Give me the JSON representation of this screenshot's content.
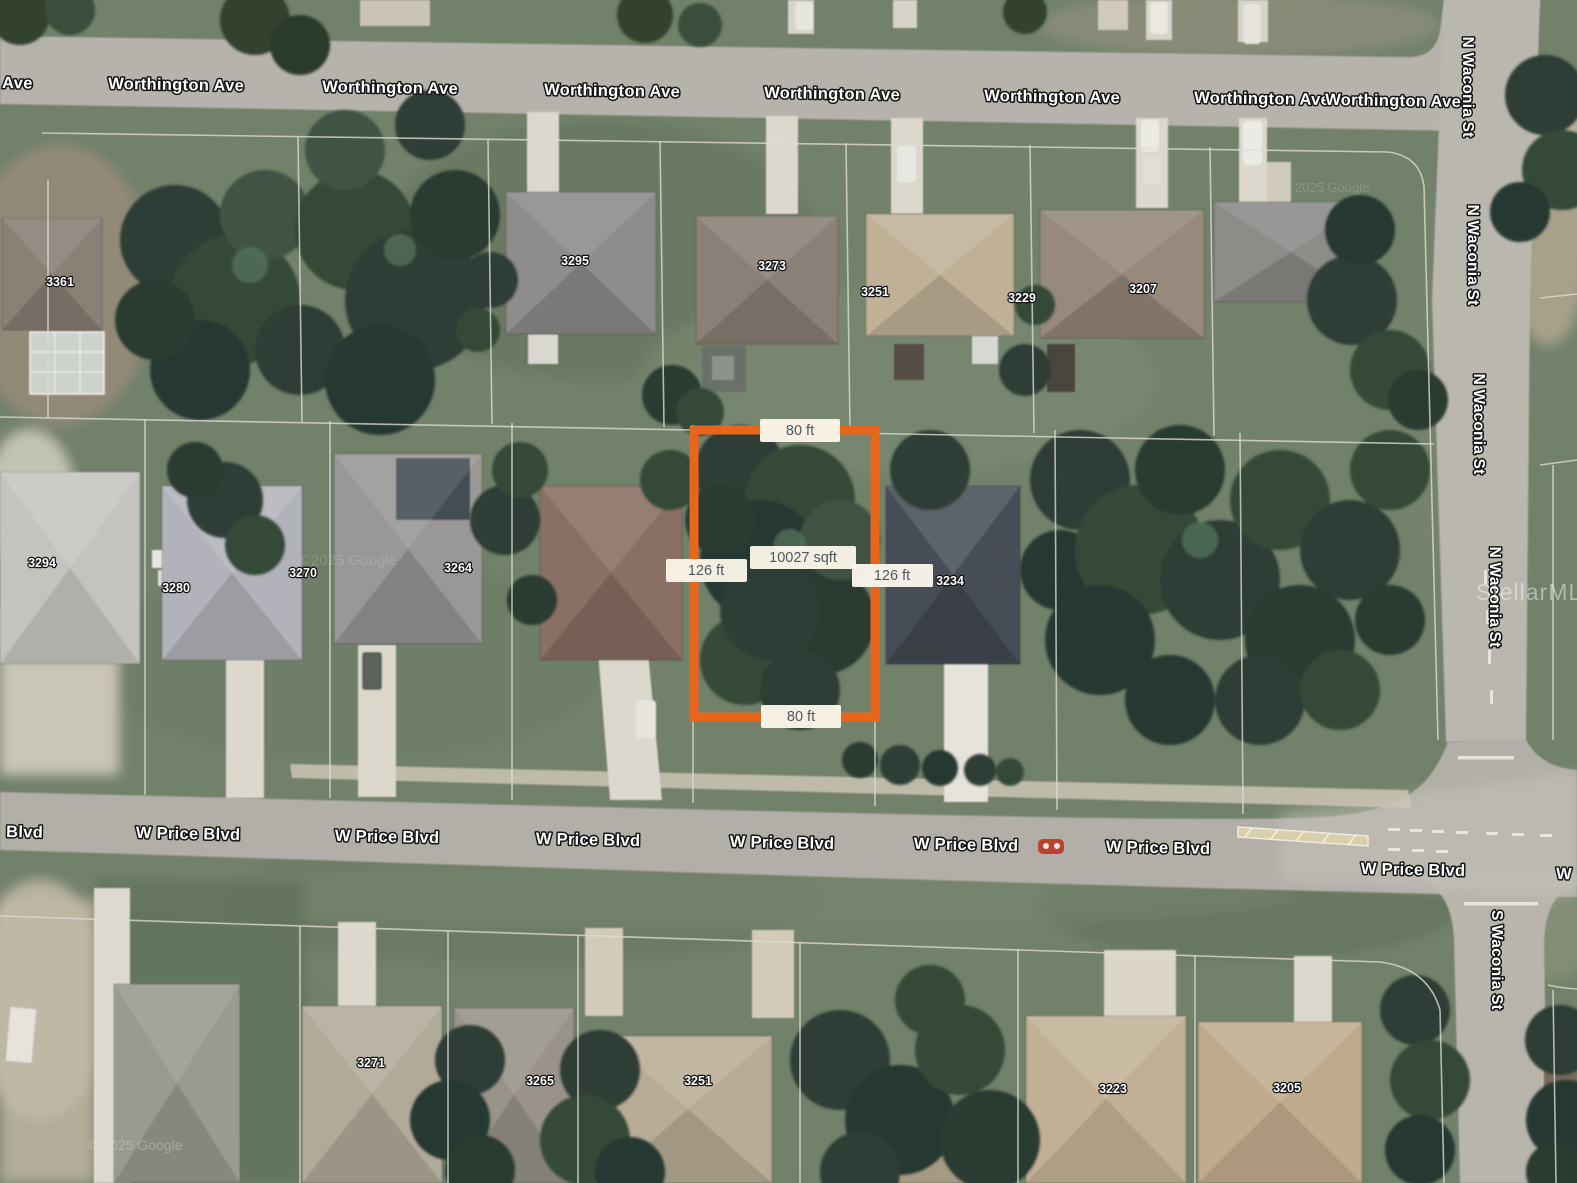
{
  "map_type": "satellite",
  "streets": {
    "worthington": {
      "label": "Worthington Ave",
      "partial_left": "Ave"
    },
    "price": {
      "label": "W Price Blvd",
      "partial_left": "Blvd",
      "partial_right": "W"
    },
    "n_waconia": {
      "label": "N Waconia St"
    },
    "s_waconia": {
      "label": "S Waconia St"
    }
  },
  "parcel": {
    "frontage_top": "80 ft",
    "frontage_bottom": "80 ft",
    "depth_left": "126 ft",
    "depth_right": "126 ft",
    "area_label": "10027 sqft",
    "outline_color": "#E8661C",
    "chip_bg": "#FAF5E8",
    "chip_text_color": "#4C5865"
  },
  "house_numbers": {
    "worthington_row": [
      "3361",
      "3295",
      "3273",
      "3251",
      "3229",
      "3207"
    ],
    "middle_row": [
      "3294",
      "3280",
      "3270",
      "3264",
      "3234"
    ],
    "price_row": [
      "3271",
      "3265",
      "3251",
      "3223",
      "3205"
    ]
  },
  "watermarks": {
    "google_upper": "2025 Google",
    "google_middle": "©2025 Google",
    "google_lower": "© 2025 Google",
    "mls": "StellarMLS"
  }
}
